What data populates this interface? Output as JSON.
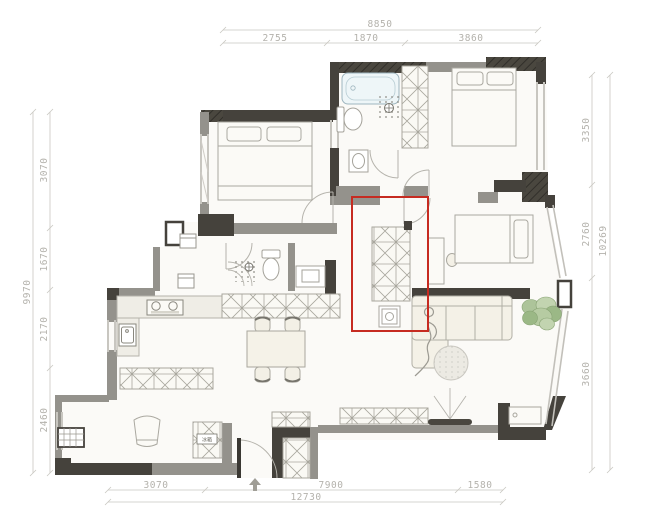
{
  "title": "apartment-floor-plan",
  "dimensions": {
    "top": {
      "overall": "8850",
      "segments": [
        "2755",
        "1870",
        "3860"
      ]
    },
    "left": {
      "overall": "9970",
      "segments": [
        "3070",
        "1670",
        "2170",
        "2460"
      ]
    },
    "right": {
      "overall": "10269",
      "segments": [
        "3350",
        "2760",
        "3660"
      ]
    },
    "bottom": {
      "overall": "12730",
      "segments": [
        "3070",
        "7900",
        "1580"
      ]
    }
  },
  "labels": {
    "fridge": "冰箱"
  },
  "highlight": {
    "color": "#c62b21"
  },
  "colors": {
    "wall_dark": "#45423c",
    "wall_gray": "#94928c",
    "floor": "#fbfaf7",
    "furniture_stroke": "#aaa8a0",
    "furniture_fill": "#f4f1e7",
    "tub_fill": "#eef6f8",
    "plant_green": "#a8c295",
    "dim_text": "#b4b2ac"
  }
}
